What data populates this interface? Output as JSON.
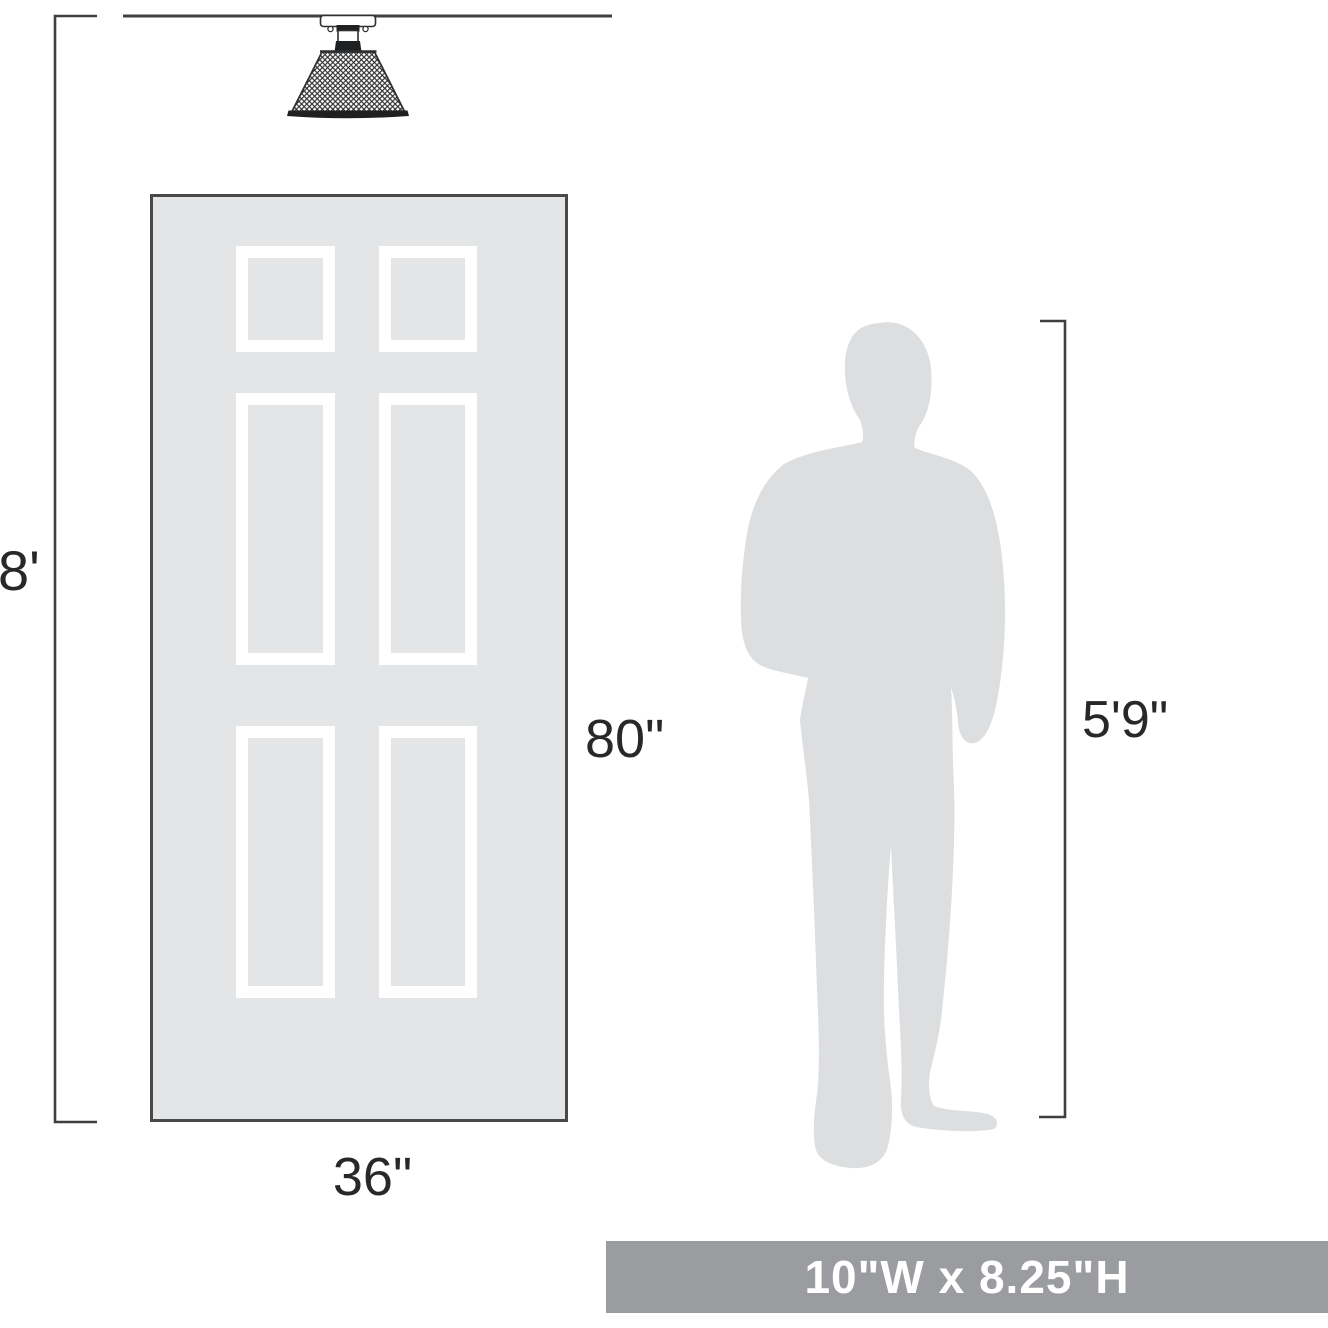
{
  "labels": {
    "ceiling_height": "8'",
    "door_height": "80\"",
    "door_width": "36\"",
    "person_height": "5'9\"",
    "product_dimensions": "10\"W x 8.25\"H"
  },
  "diagram": {
    "type": "product-scale-diagram",
    "product_icon": "flush-mount-mesh-shade-ceiling-light",
    "references": [
      "six-panel-door",
      "standing-man-silhouette"
    ],
    "values": {
      "ceiling_height_ft": 8,
      "door_height_in": 80,
      "door_width_in": 36,
      "person_height": "5'9\"",
      "product_width_in": 10,
      "product_height_in": 8.25
    }
  },
  "colors": {
    "line": "#3e3f41",
    "text": "#27282a",
    "door_fill": "#e4e5e7",
    "door_border": "#48494b",
    "panel_frame": "#ffffff",
    "person_fill": "#dcdee0",
    "banner_fill": "#9a9c9f",
    "banner_text": "#ffffff",
    "fixture_dark": "#1f2022",
    "fixture_outline": "#2e2f31",
    "canvas_bg": "#ffffff"
  }
}
